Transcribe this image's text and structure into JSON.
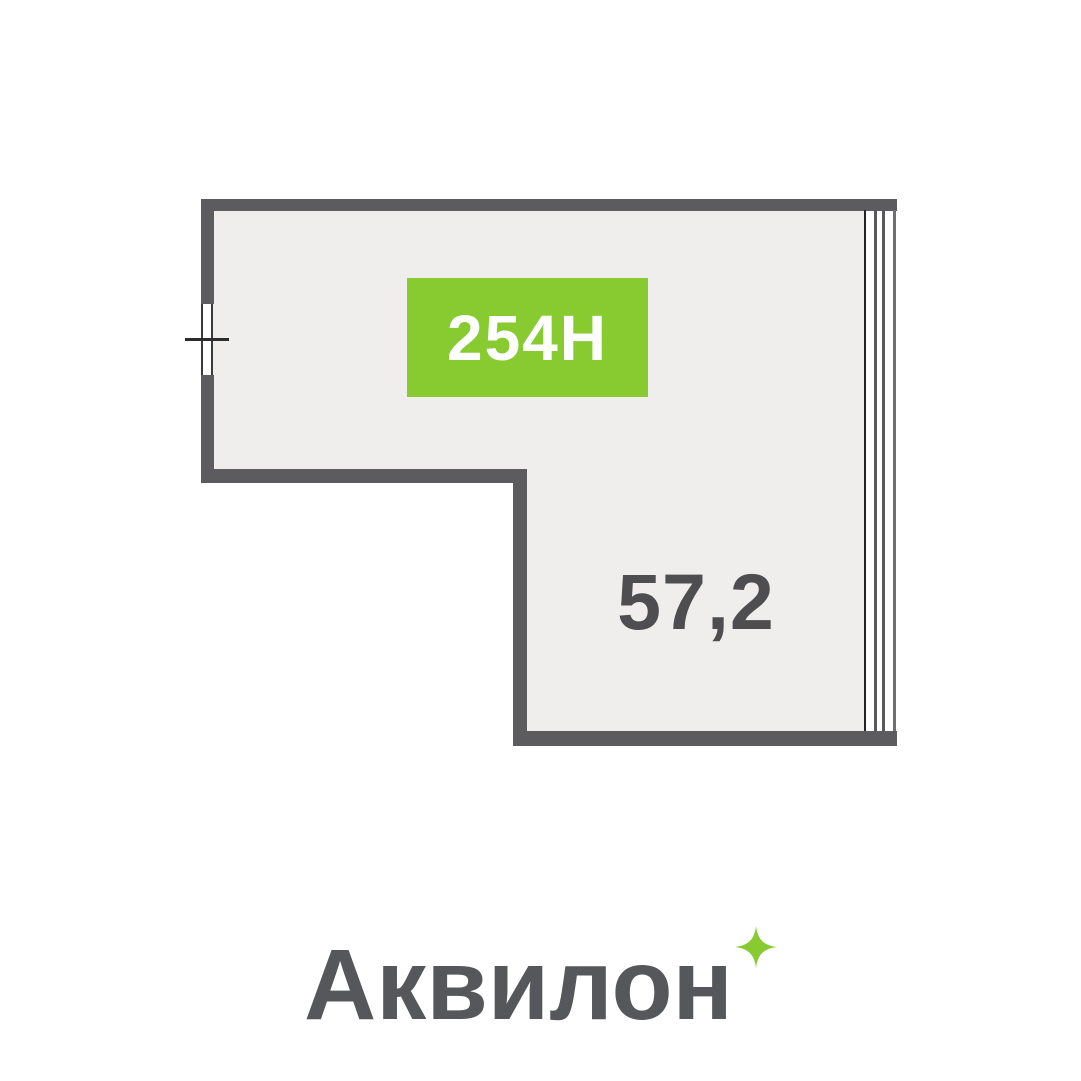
{
  "page": {
    "background_color": "#ffffff"
  },
  "floor_plan": {
    "unit": {
      "label": "254Н",
      "badge_color": "#87cb31",
      "text_color": "#ffffff"
    },
    "area": {
      "value": "57,2",
      "text_color": "#4e4e50"
    },
    "colors": {
      "wall": "#5c5c5e",
      "floor": "#efeeec",
      "glazing_line_dark": "#242424",
      "glazing_line_gray": "#59595b"
    }
  },
  "footer": {
    "brand": "Аквилон",
    "brand_color": "#56575a",
    "sparkle_color": "#87cb31"
  }
}
